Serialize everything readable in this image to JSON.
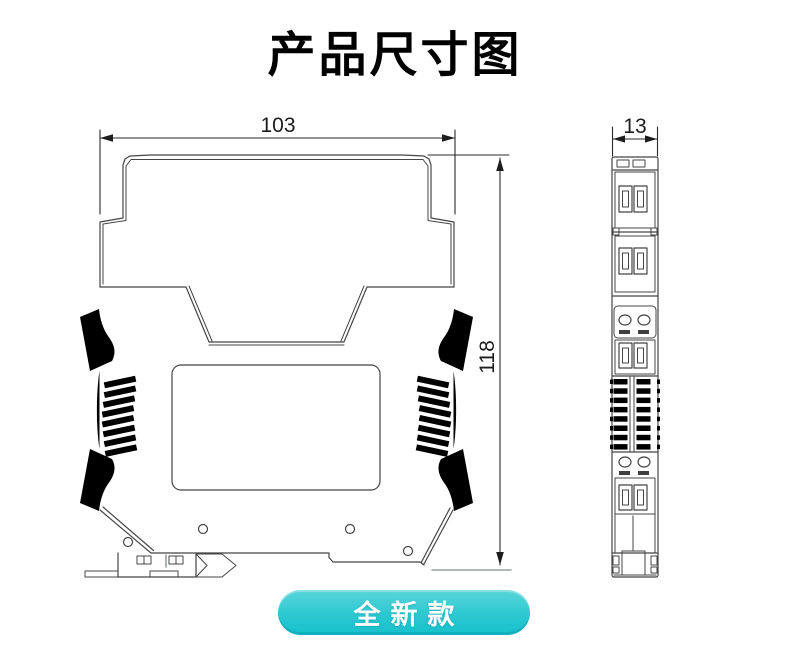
{
  "page": {
    "background": "#ffffff"
  },
  "title": {
    "text": "产品尺寸图",
    "color": "#000000"
  },
  "drawing": {
    "type": "technical-dimension-diagram",
    "line_color": "#454545",
    "side_view": {
      "width_dim": "103",
      "height_dim": "118"
    },
    "front_view": {
      "width_dim": "13"
    }
  },
  "badge": {
    "label": "全新款",
    "text_color": "#ffffff",
    "gradient_top": "#5ad5da",
    "gradient_bottom": "#16c1cc"
  }
}
